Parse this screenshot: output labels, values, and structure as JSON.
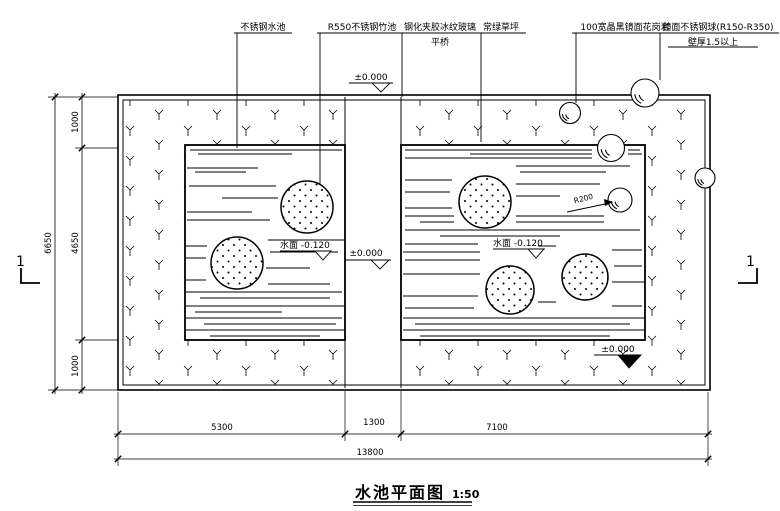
{
  "title": {
    "name": "水池平面图",
    "scale": "1:50"
  },
  "callouts": {
    "steel_pool": "不锈钢水池",
    "bamboo": "R550不锈钢竹池",
    "glass_line1": "钢化夹胶冰纹玻璃",
    "glass_line2": "平桥",
    "lawn": "常绿草坪",
    "granite": "100宽晶黑镜面花岗岩",
    "ball_line1": "镜面不锈钢球(R150-R350)",
    "ball_line2": "壁厚1.5以上"
  },
  "levels": {
    "datum": "±0.000",
    "water": "水面 -0.120",
    "ball_radius": "R200"
  },
  "dims": {
    "left": {
      "overall": "6650",
      "top": "1000",
      "mid": "4650",
      "bottom": "1000"
    },
    "bottom": {
      "overall": "13800",
      "s1": "5300",
      "s2": "1300",
      "s3": "7100"
    }
  },
  "section": {
    "left": "1",
    "right": "1"
  },
  "colors": {
    "line": "#000000",
    "bg": "#ffffff"
  }
}
